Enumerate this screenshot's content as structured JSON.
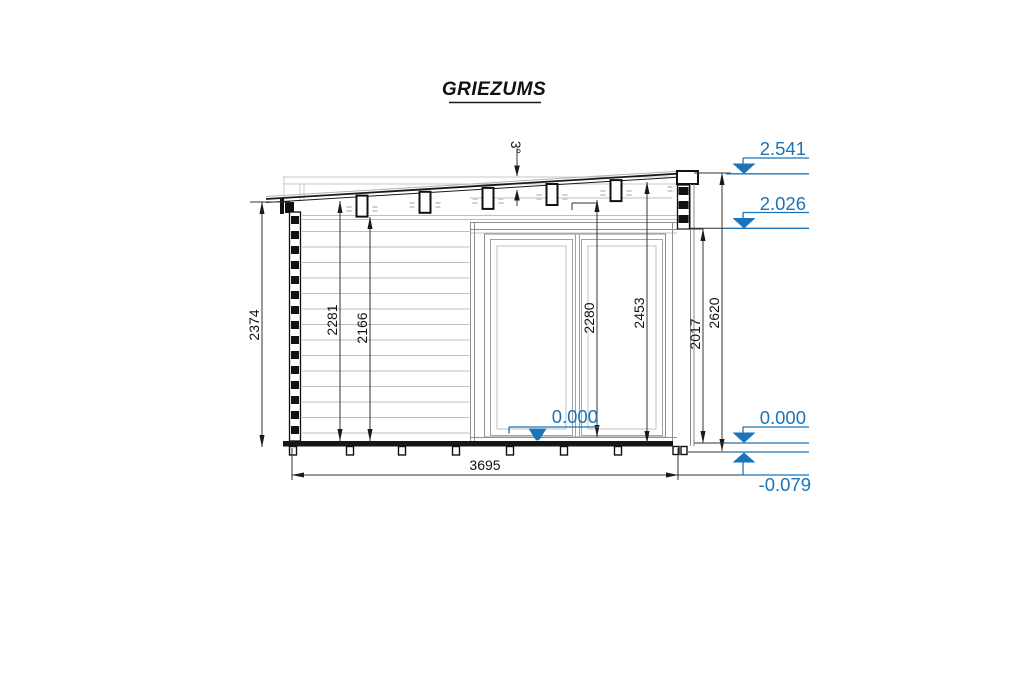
{
  "title": "GRIEZUMS",
  "drawing": {
    "angle_label": "3°",
    "dimensions": {
      "overall_height_left": "2374",
      "interior_height_1": "2281",
      "interior_height_2": "2166",
      "door_opening_height": "2280",
      "interior_height_right": "2453",
      "door_top_height": "2017",
      "overall_height_right": "2620",
      "overall_width": "3695"
    },
    "elevations": {
      "roof_top": "2.541",
      "wall_top": "2.026",
      "floor_interior": "0.000",
      "floor_right": "0.000",
      "foundation": "-0.079"
    }
  },
  "colors": {
    "elevation_blue": "#1b74b8",
    "line_black": "#1a1a1a",
    "board_gray": "#bdbdbd"
  }
}
